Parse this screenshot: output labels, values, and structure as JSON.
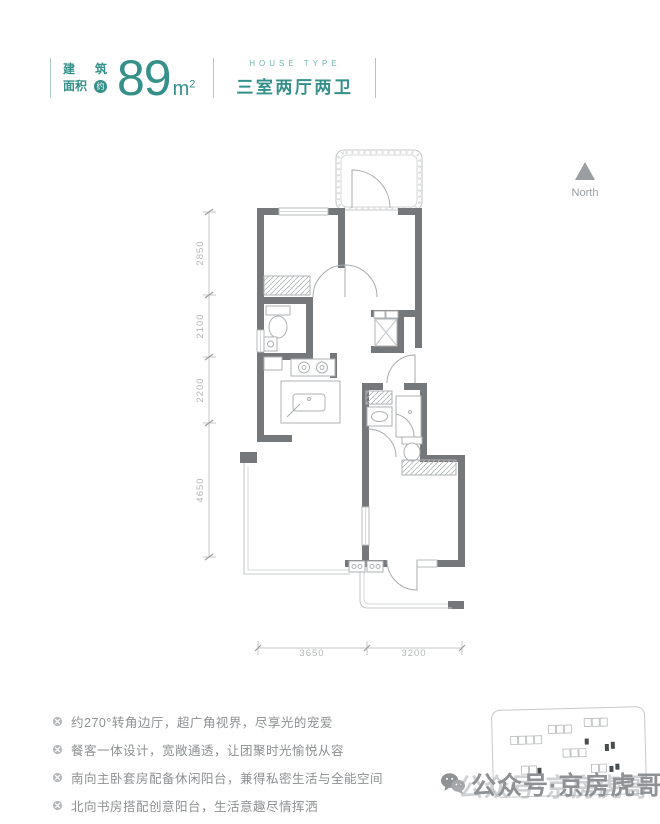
{
  "header": {
    "label_line1_a": "建",
    "label_line1_b": "筑",
    "label_line2": "面积",
    "label_circle": "约",
    "area_value": "89",
    "area_unit": "m",
    "area_sup": "2",
    "type_en": "HOUSE TYPE",
    "type_cn": "三室两厅两卫"
  },
  "north": {
    "label": "North"
  },
  "floorplan": {
    "left_dims": [
      "2850",
      "2100",
      "2200",
      "4650"
    ],
    "bottom_dims": [
      "3650",
      "3200"
    ]
  },
  "features": {
    "items": [
      "约270°转角边厅，超广角视界，尽享光的宠爱",
      "餐客一体设计，宽敞通透，让团聚时光愉悦从容",
      "南向主卧套房配备休闲阳台，兼得私密生活与全能空间",
      "北向书房搭配创意阳台，生活意趣尽情挥洒"
    ]
  },
  "watermark": {
    "text": "公众号·京房虎哥"
  },
  "colors": {
    "teal": "#35908a",
    "wall": "#75787a",
    "light_line": "#c6c9cb",
    "dim_text": "#b3b6b8",
    "feature_text": "#8d9092"
  }
}
